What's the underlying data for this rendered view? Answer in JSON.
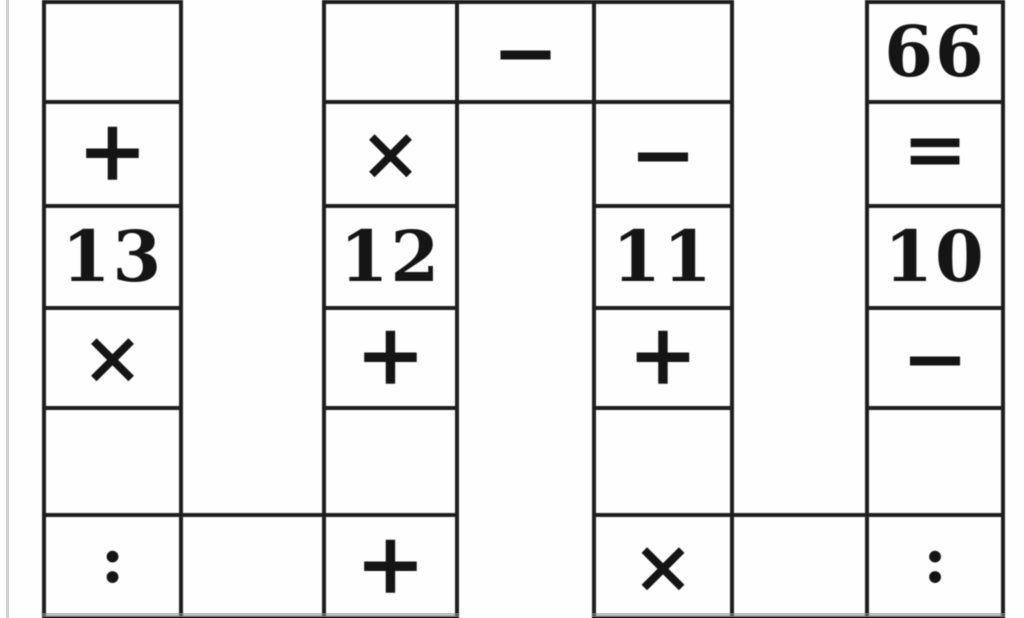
{
  "page": {
    "kind": "scanned arithmetic cross-number puzzle grid (cropped view)"
  },
  "colors": {
    "background": "#fefefe",
    "grid_line": "#1f1f1f",
    "text": "#151515",
    "scan_edge": "#d2d2d2"
  },
  "grid": {
    "visible_rows": 6,
    "columns": 7,
    "cells": [
      {
        "row": 1,
        "col": 1,
        "type": "empty",
        "value": ""
      },
      {
        "row": 1,
        "col": 3,
        "type": "empty",
        "value": ""
      },
      {
        "row": 1,
        "col": 4,
        "type": "operator",
        "value": "−"
      },
      {
        "row": 1,
        "col": 5,
        "type": "empty",
        "value": ""
      },
      {
        "row": 1,
        "col": 7,
        "type": "number",
        "value": "66"
      },
      {
        "row": 2,
        "col": 1,
        "type": "operator",
        "value": "+"
      },
      {
        "row": 2,
        "col": 3,
        "type": "operator",
        "value": "×"
      },
      {
        "row": 2,
        "col": 5,
        "type": "operator",
        "value": "−"
      },
      {
        "row": 2,
        "col": 7,
        "type": "operator",
        "value": "="
      },
      {
        "row": 3,
        "col": 1,
        "type": "number",
        "value": "13"
      },
      {
        "row": 3,
        "col": 3,
        "type": "number",
        "value": "12"
      },
      {
        "row": 3,
        "col": 5,
        "type": "number",
        "value": "11"
      },
      {
        "row": 3,
        "col": 7,
        "type": "number",
        "value": "10"
      },
      {
        "row": 4,
        "col": 1,
        "type": "operator",
        "value": "×"
      },
      {
        "row": 4,
        "col": 3,
        "type": "operator",
        "value": "+"
      },
      {
        "row": 4,
        "col": 5,
        "type": "operator",
        "value": "+"
      },
      {
        "row": 4,
        "col": 7,
        "type": "operator",
        "value": "−"
      },
      {
        "row": 5,
        "col": 1,
        "type": "empty",
        "value": ""
      },
      {
        "row": 5,
        "col": 3,
        "type": "empty",
        "value": ""
      },
      {
        "row": 5,
        "col": 5,
        "type": "empty",
        "value": ""
      },
      {
        "row": 5,
        "col": 7,
        "type": "empty",
        "value": ""
      },
      {
        "row": 6,
        "col": 1,
        "type": "operator",
        "value": ":"
      },
      {
        "row": 6,
        "col": 2,
        "type": "empty",
        "value": ""
      },
      {
        "row": 6,
        "col": 3,
        "type": "operator",
        "value": "+"
      },
      {
        "row": 6,
        "col": 5,
        "type": "operator",
        "value": "×"
      },
      {
        "row": 6,
        "col": 6,
        "type": "empty",
        "value": ""
      },
      {
        "row": 6,
        "col": 7,
        "type": "operator",
        "value": ":"
      }
    ]
  }
}
